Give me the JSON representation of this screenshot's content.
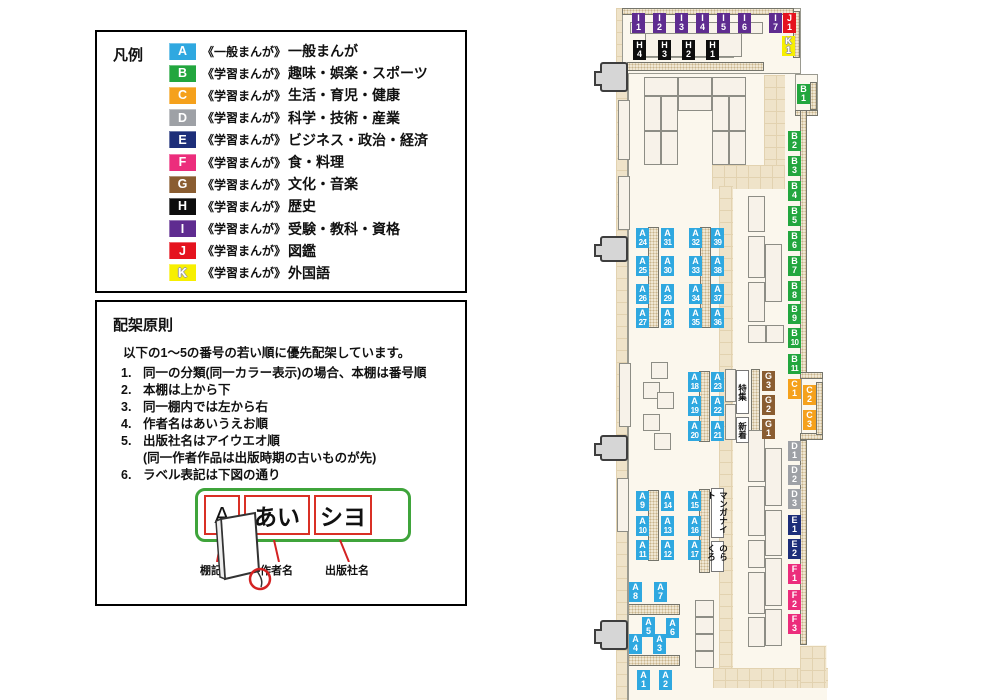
{
  "legend": {
    "title": "凡例",
    "items": [
      {
        "code": "A",
        "color": "#2FA8E0",
        "series": "《一般まんが》",
        "category": "一般まんが"
      },
      {
        "code": "B",
        "color": "#22A63E",
        "series": "《学習まんが》",
        "category": "趣味・娯楽・スポーツ"
      },
      {
        "code": "C",
        "color": "#F5A11C",
        "series": "《学習まんが》",
        "category": "生活・育児・健康"
      },
      {
        "code": "D",
        "color": "#9EA1A6",
        "series": "《学習まんが》",
        "category": "科学・技術・産業"
      },
      {
        "code": "E",
        "color": "#1D2E79",
        "series": "《学習まんが》",
        "category": "ビジネス・政治・経済"
      },
      {
        "code": "F",
        "color": "#EC2D7C",
        "series": "《学習まんが》",
        "category": "食・料理"
      },
      {
        "code": "G",
        "color": "#8A5D31",
        "series": "《学習まんが》",
        "category": "文化・音楽"
      },
      {
        "code": "H",
        "color": "#0D0D0D",
        "series": "《学習まんが》",
        "category": "歴史"
      },
      {
        "code": "I",
        "color": "#5F2C90",
        "series": "《学習まんが》",
        "category": "受験・教科・資格"
      },
      {
        "code": "J",
        "color": "#E5131E",
        "series": "《学習まんが》",
        "category": "図鑑"
      },
      {
        "code": "K",
        "color": "#F7EF00",
        "series": "《学習まんが》",
        "category": "外国語"
      }
    ]
  },
  "principles": {
    "title": "配架原則",
    "intro": "以下の1〜5の番号の若い順に優先配架しています。",
    "rules": [
      {
        "num": "1.",
        "text": "同一の分類(同一カラー表示)の場合、本棚は番号順"
      },
      {
        "num": "2.",
        "text": "本棚は上から下"
      },
      {
        "num": "3.",
        "text": "同一棚内では左から右"
      },
      {
        "num": "4.",
        "text": "作者名はあいうえお順"
      },
      {
        "num": "5.",
        "text": "出版社名はアイウエオ順",
        "sub": "(同一作者作品は出版時期の古いものが先)"
      },
      {
        "num": "6.",
        "text": "ラベル表記は下図の通り"
      }
    ],
    "label_example": {
      "shelf_code": "A",
      "author": "あい",
      "publisher": "シヨ",
      "captions": [
        "棚記号",
        "作者名",
        "出版社名"
      ]
    }
  },
  "map": {
    "category_colors": {
      "A": "#2FA8E0",
      "B": "#22A63E",
      "C": "#F5A11C",
      "D": "#9EA1A6",
      "E": "#1D2E79",
      "F": "#EC2D7C",
      "G": "#8A5D31",
      "H": "#0D0D0D",
      "I": "#5F2C90",
      "J": "#E5131E",
      "K": "#F7EF00"
    },
    "shelf_labels": [
      [
        "I1",
        632,
        13
      ],
      [
        "I2",
        653,
        13
      ],
      [
        "I3",
        675,
        13
      ],
      [
        "I4",
        696,
        13
      ],
      [
        "I5",
        717,
        13
      ],
      [
        "I6",
        738,
        13
      ],
      [
        "I7",
        769,
        13
      ],
      [
        "J1",
        783,
        13
      ],
      [
        "K1",
        782,
        36
      ],
      [
        "H4",
        633,
        40
      ],
      [
        "H3",
        658,
        40
      ],
      [
        "H2",
        682,
        40
      ],
      [
        "H1",
        706,
        40
      ],
      [
        "B1",
        797,
        84
      ],
      [
        "B2",
        788,
        131
      ],
      [
        "B3",
        788,
        156
      ],
      [
        "B4",
        788,
        181
      ],
      [
        "B5",
        788,
        206
      ],
      [
        "B6",
        788,
        231
      ],
      [
        "B7",
        788,
        256
      ],
      [
        "B8",
        788,
        281
      ],
      [
        "B9",
        788,
        304
      ],
      [
        "B10",
        788,
        328
      ],
      [
        "B11",
        788,
        354
      ],
      [
        "C1",
        788,
        379
      ],
      [
        "C2",
        803,
        385
      ],
      [
        "C3",
        803,
        410
      ],
      [
        "G3",
        762,
        371
      ],
      [
        "G2",
        762,
        395
      ],
      [
        "G1",
        762,
        419
      ],
      [
        "D1",
        788,
        441
      ],
      [
        "D2",
        788,
        465
      ],
      [
        "D3",
        788,
        489
      ],
      [
        "E1",
        788,
        515
      ],
      [
        "E2",
        788,
        539
      ],
      [
        "F1",
        788,
        564
      ],
      [
        "F2",
        788,
        590
      ],
      [
        "F3",
        788,
        614
      ],
      [
        "A24",
        636,
        228
      ],
      [
        "A31",
        661,
        228
      ],
      [
        "A32",
        689,
        228
      ],
      [
        "A39",
        711,
        228
      ],
      [
        "A25",
        636,
        256
      ],
      [
        "A30",
        661,
        256
      ],
      [
        "A33",
        689,
        256
      ],
      [
        "A38",
        711,
        256
      ],
      [
        "A26",
        636,
        284
      ],
      [
        "A29",
        661,
        284
      ],
      [
        "A34",
        689,
        284
      ],
      [
        "A37",
        711,
        284
      ],
      [
        "A27",
        636,
        308
      ],
      [
        "A28",
        661,
        308
      ],
      [
        "A35",
        689,
        308
      ],
      [
        "A36",
        711,
        308
      ],
      [
        "A18",
        688,
        372
      ],
      [
        "A23",
        711,
        372
      ],
      [
        "A19",
        688,
        396
      ],
      [
        "A22",
        711,
        396
      ],
      [
        "A20",
        688,
        421
      ],
      [
        "A21",
        711,
        421
      ],
      [
        "A9",
        636,
        491
      ],
      [
        "A14",
        661,
        491
      ],
      [
        "A15",
        688,
        491
      ],
      [
        "A10",
        636,
        516
      ],
      [
        "A13",
        661,
        516
      ],
      [
        "A16",
        688,
        516
      ],
      [
        "A11",
        636,
        540
      ],
      [
        "A12",
        661,
        540
      ],
      [
        "A17",
        688,
        540
      ],
      [
        "A8",
        629,
        582
      ],
      [
        "A7",
        654,
        582
      ],
      [
        "A5",
        642,
        617
      ],
      [
        "A6",
        666,
        618
      ],
      [
        "A4",
        629,
        634
      ],
      [
        "A3",
        653,
        634
      ],
      [
        "A1",
        637,
        670
      ],
      [
        "A2",
        659,
        670
      ]
    ],
    "sign_boxes": [
      {
        "id": "special-feature",
        "text": "特集",
        "x": 736,
        "y": 370,
        "h": 44
      },
      {
        "id": "new-arrivals",
        "text": "新着",
        "x": 736,
        "y": 417,
        "h": 26
      },
      {
        "id": "manga-night",
        "text": "マンガナイト",
        "x": 711,
        "y": 488,
        "h": 50
      },
      {
        "id": "norakuro",
        "text": "のらくろ",
        "x": 711,
        "y": 541,
        "h": 31
      }
    ]
  }
}
